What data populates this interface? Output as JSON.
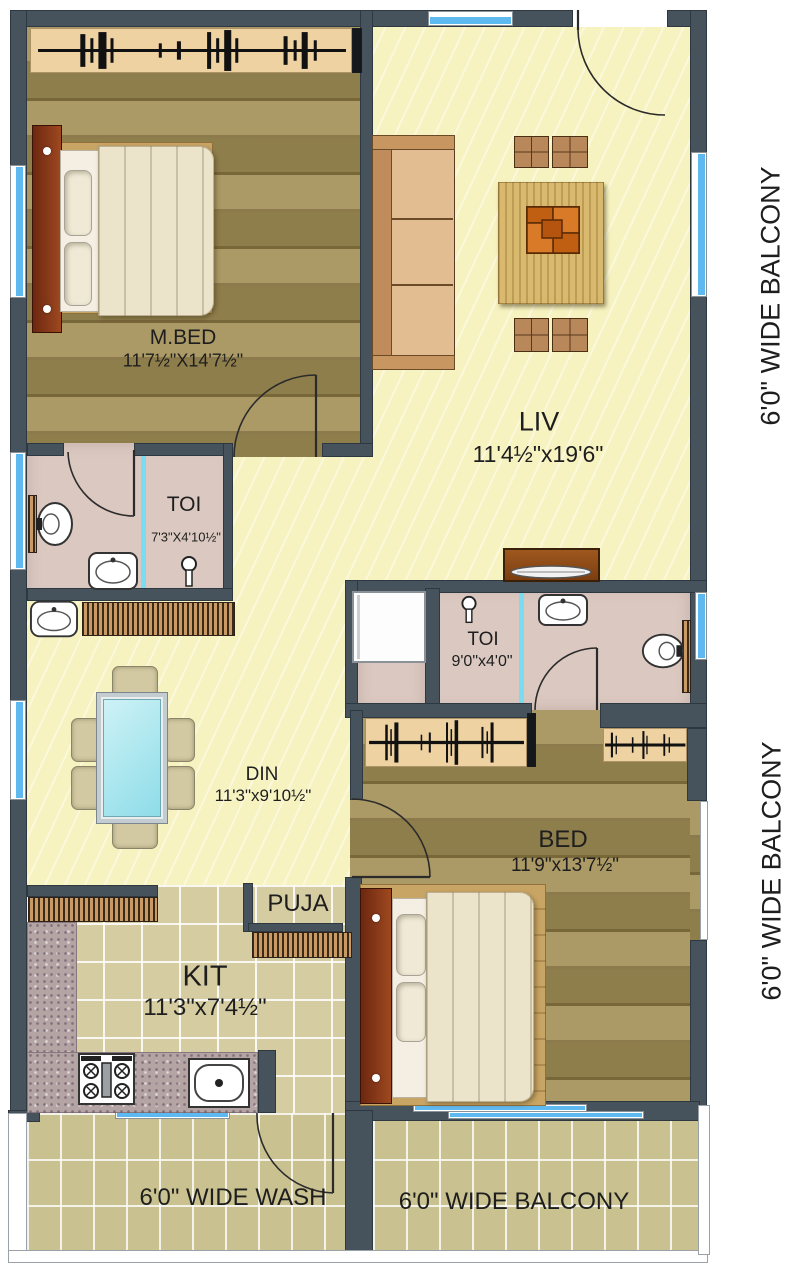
{
  "plan": {
    "rooms": {
      "mbed": {
        "name": "M.BED",
        "size": "11'7½\"X14'7½\""
      },
      "liv": {
        "name": "LIV",
        "size": "11'4½\"x19'6\""
      },
      "toi1": {
        "name": "TOI",
        "size": "7'3\"X4'10½\""
      },
      "toi2": {
        "name": "TOI",
        "size": "9'0\"x4'0\""
      },
      "din": {
        "name": "DIN",
        "size": "11'3\"x9'10½\""
      },
      "bed": {
        "name": "BED",
        "size": "11'9\"x13'7½\""
      },
      "puja": {
        "name": "PUJA"
      },
      "kit": {
        "name": "KIT",
        "size": "11'3\"x7'4½\""
      }
    },
    "labels": {
      "wash": "6'0\" WIDE WASH",
      "balcony_bottom": "6'0\" WIDE BALCONY",
      "balcony_right_top": "6'0\" WIDE BALCONY",
      "balcony_right_bottom": "6'0\" WIDE BALCONY"
    },
    "colors": {
      "wall": "#46525c",
      "wood_floor": "#a28f55",
      "living_floor": "#f7f3c0",
      "toilet_floor": "#dbc9c1",
      "kitchen_floor": "#d6cca1",
      "balcony_floor": "#c9c18f",
      "window_blue": "#5fb9f1",
      "wardrobe_tan": "#eed2a2",
      "glass_table": "#8edce8",
      "coffee_table": "#cf6d1d",
      "bed_headboard": "#7a2f12"
    }
  }
}
